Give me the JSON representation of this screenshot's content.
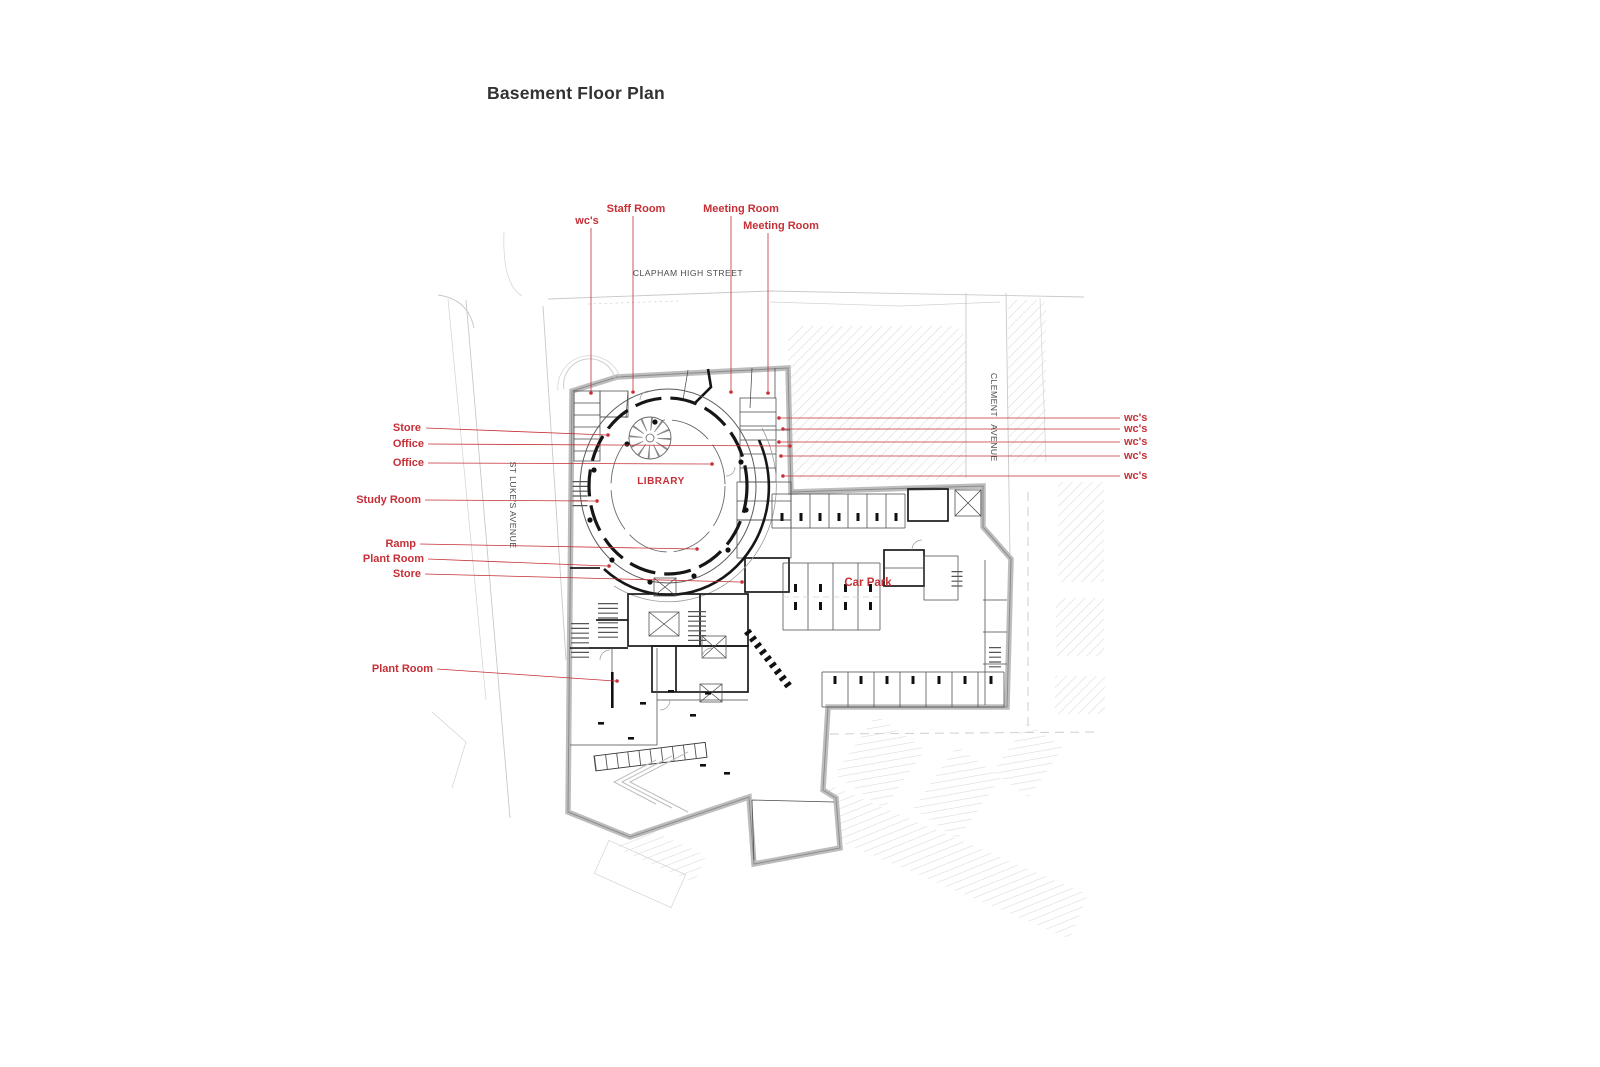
{
  "title": "Basement Floor Plan",
  "streets": {
    "clapham_high_street": "CLAPHAM HIGH STREET",
    "clement_word1": "CLEMENT",
    "clement_word2": "AVENUE",
    "st_lukes_avenue": "ST LUKE'S AVENUE"
  },
  "plan_labels": {
    "library": "LIBRARY",
    "car_park": "Car Park"
  },
  "annotations": {
    "top": [
      {
        "text": "wc's"
      },
      {
        "text": "Staff Room"
      },
      {
        "text": "Meeting Room"
      },
      {
        "text": "Meeting Room"
      }
    ],
    "left": [
      {
        "text": "Store"
      },
      {
        "text": "Office"
      },
      {
        "text": "Office"
      },
      {
        "text": "Study Room"
      },
      {
        "text": "Ramp"
      },
      {
        "text": "Plant Room"
      },
      {
        "text": "Store"
      },
      {
        "text": "Plant Room"
      }
    ],
    "right": [
      {
        "text": "wc's"
      },
      {
        "text": "wc's"
      },
      {
        "text": "wc's"
      },
      {
        "text": "wc's"
      },
      {
        "text": "wc's"
      }
    ]
  },
  "colors": {
    "annotation_red": "#c62f36",
    "plan_line": "#4a4a4a",
    "wall_gray": "#bdbdbd",
    "hatch_gray": "#d8d8d8"
  }
}
